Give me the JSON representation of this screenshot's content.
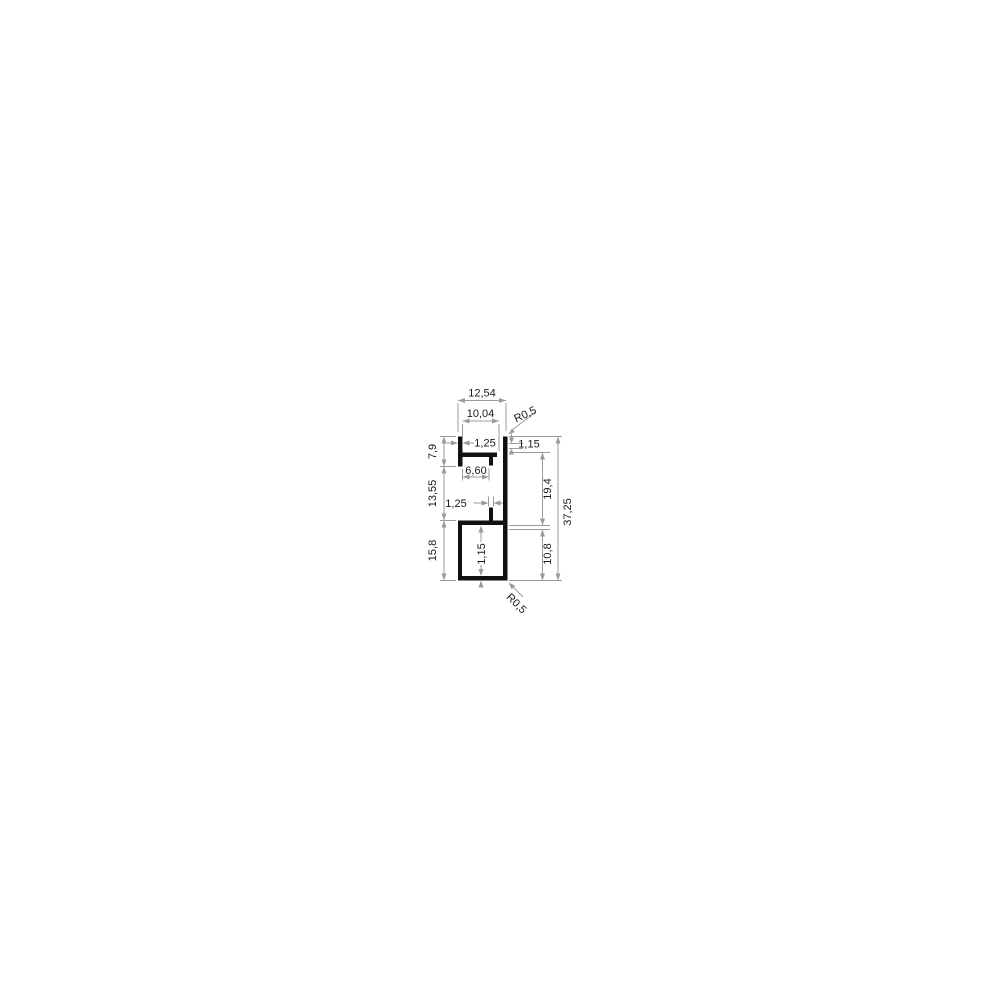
{
  "drawing": {
    "type": "technical-cross-section",
    "units_style": "decimal-comma",
    "colors": {
      "background": "#ffffff",
      "profile": "#111111",
      "dimension_lines": "#9b9b9b",
      "text": "#1a1a1a"
    },
    "labels": {
      "overall_width": "12,54",
      "flange_width": "10,04",
      "radius_top": "R0,5",
      "tab_thickness": "1,25",
      "flange_thickness": "1,15",
      "slot_opening": "6,60",
      "height_top_left": "7,9",
      "height_middle_left": "13,55",
      "height_bottom_left": "15,8",
      "stub_width": "1,25",
      "wall_thickness": "1,15",
      "height_upper_right": "19,4",
      "height_lower_right": "10,8",
      "overall_height": "37,25",
      "radius_bottom": "R0,5"
    }
  }
}
